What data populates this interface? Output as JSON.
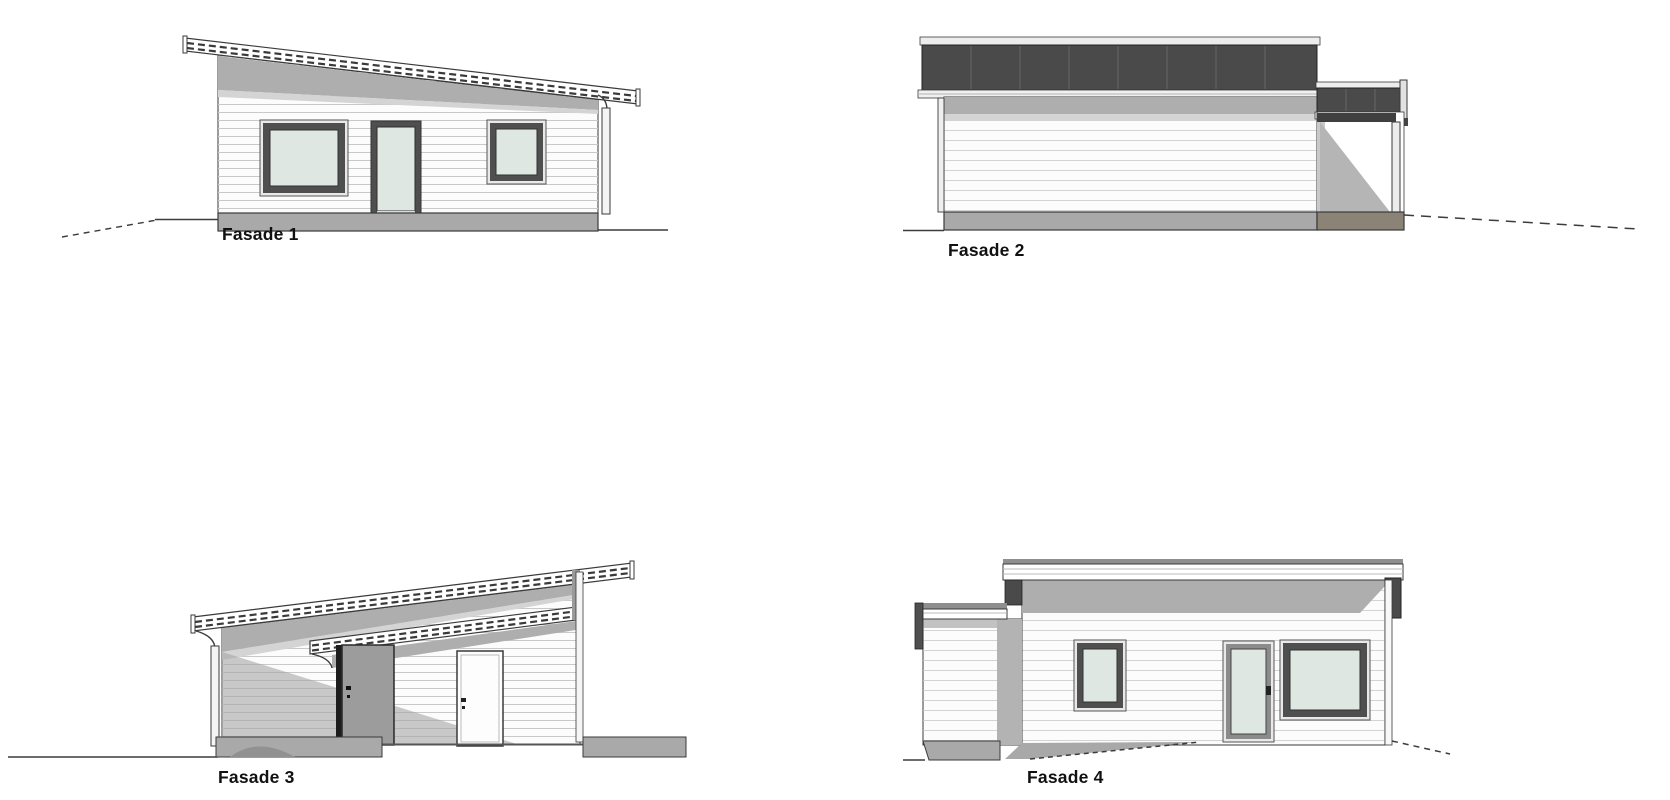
{
  "colors": {
    "wall": "#fcfcfc",
    "glass": "#dfe7e2",
    "roof-dark": "#4a4a4a",
    "roof-seam": "#5e5e5e",
    "foundation": "#a9a9a9",
    "slab-brown": "#8b8376",
    "door-gray": "#9c9c9c",
    "eave-shadow": "#aeaeae",
    "eave-shadow-light": "#d4d4d4",
    "carport-shadow": "#a5a5a5",
    "post-tan": "#c6b687",
    "frame-dark": "#4f4f4f",
    "trim-light": "#e9e9e9",
    "fascia": "#ffffff",
    "siding-line": "#c9c9c9",
    "outline": "#3a3a3a",
    "ground-line": "#3c3c3c",
    "label-color": "#111111"
  },
  "views": [
    {
      "id": "fasade-1",
      "label": "Fasade 1",
      "view": "elevation, pent roof sloping down to the right, large window, glazed door, small window"
    },
    {
      "id": "fasade-2",
      "label": "Fasade 2",
      "view": "side elevation, dark pent roof seen edge-on, blank clad wall, open carport at right"
    },
    {
      "id": "fasade-3",
      "label": "Fasade 3",
      "view": "elevation, pent roof sloping up to the right, entrance canopy, gray door, white door, open carport at left"
    },
    {
      "id": "fasade-4",
      "label": "Fasade 4",
      "view": "side elevation, flat-roofed annex at left, small window, glazed door, large window, driveway"
    }
  ]
}
